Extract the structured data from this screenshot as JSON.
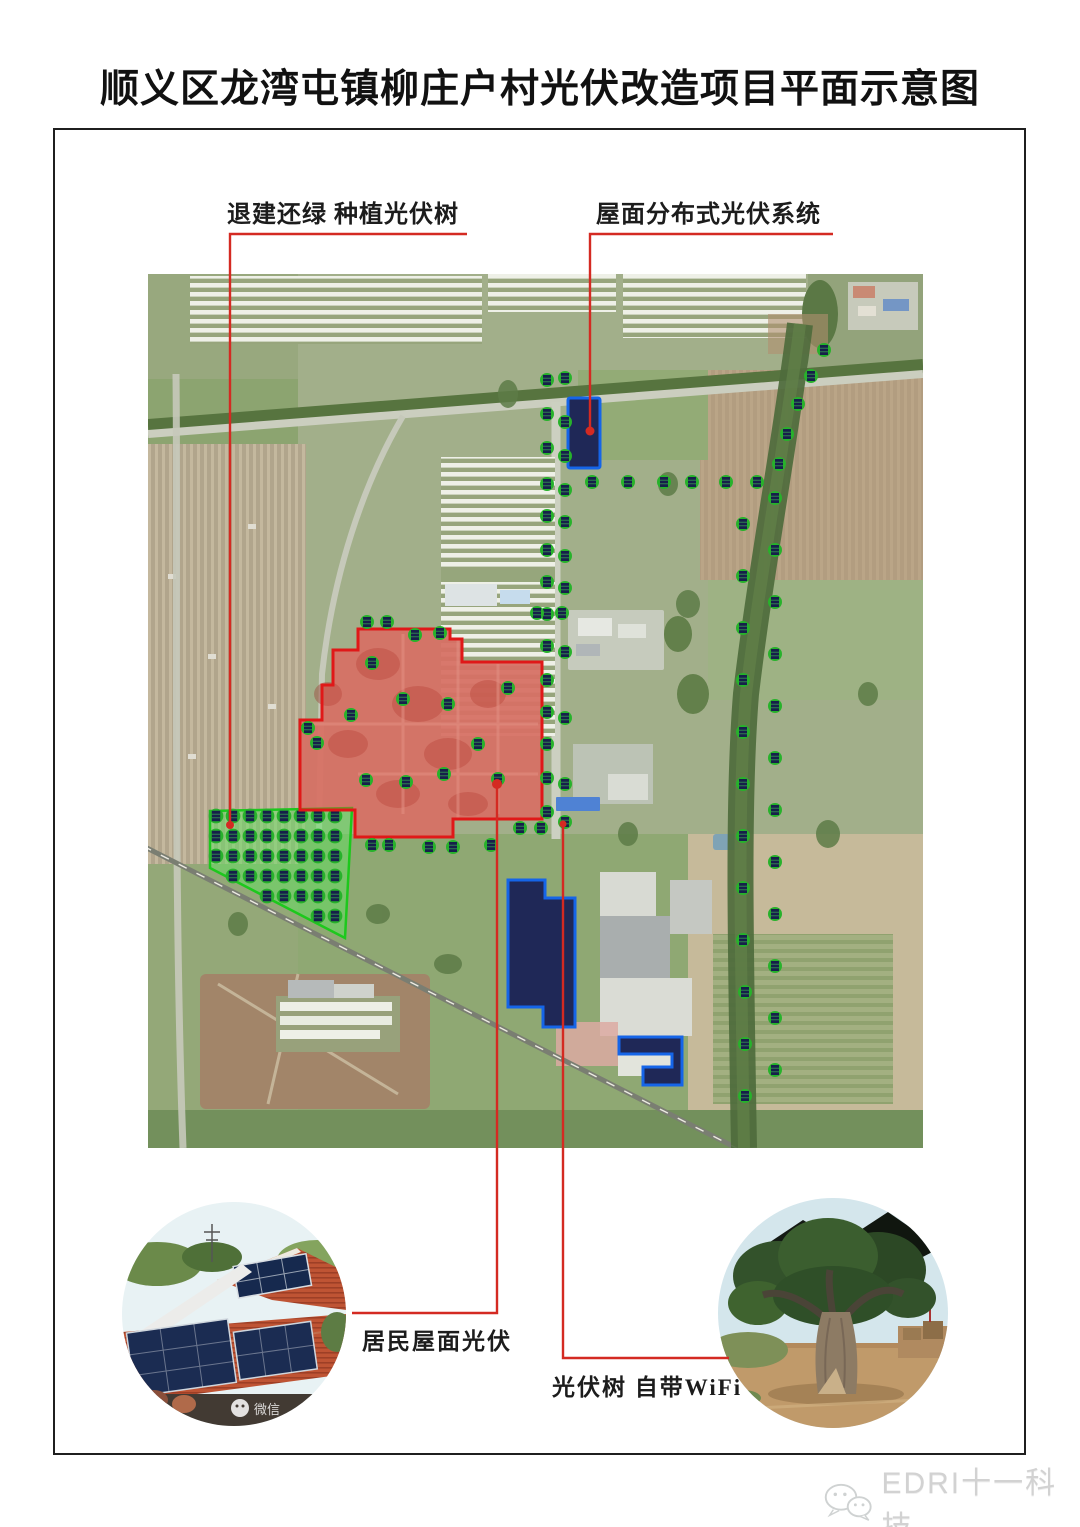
{
  "page": {
    "title": "顺义区龙湾屯镇柳庄户村光伏改造项目平面示意图",
    "watermark_text": "EDRI十一科技"
  },
  "annotations": {
    "top_left_label": "退建还绿 种植光伏树",
    "top_right_label": "屋面分布式光伏系统",
    "bottom_left_label": "居民屋面光伏",
    "bottom_right_label": "光伏树 自带WiFi"
  },
  "legend_photos": {
    "left": {
      "content": "rooftop solar panels on red tile roofs",
      "photo_watermark": "微信"
    },
    "right": {
      "content": "photovoltaic tree"
    }
  },
  "colors": {
    "accent_red": "#d42a22",
    "zone_red": "#e01818",
    "zone_green": "#1dc81d",
    "pv_blue_border": "#1565e8",
    "pv_blue_fill": "#1f2857",
    "dot_green": "#27b22b",
    "watermark_grey": "#d2d2d2"
  },
  "map": {
    "type": "satellite-plan",
    "overlays": {
      "village_zone": {
        "meaning": "rooftop PV village area",
        "stroke": "#e01818"
      },
      "green_return_zone": {
        "meaning": "demolish & re-green, plant PV trees",
        "stroke": "#1dc81d"
      },
      "rooftop_pv_buildings_count": 3,
      "pv_tree_dot_count": 123
    },
    "pv_tree_dots": [
      [
        399,
        106
      ],
      [
        417,
        104
      ],
      [
        399,
        140
      ],
      [
        417,
        148
      ],
      [
        399,
        174
      ],
      [
        417,
        182
      ],
      [
        399,
        210
      ],
      [
        417,
        216
      ],
      [
        399,
        242
      ],
      [
        417,
        248
      ],
      [
        399,
        276
      ],
      [
        417,
        282
      ],
      [
        399,
        308
      ],
      [
        417,
        314
      ],
      [
        399,
        340
      ],
      [
        399,
        372
      ],
      [
        417,
        378
      ],
      [
        399,
        406
      ],
      [
        399,
        438
      ],
      [
        417,
        444
      ],
      [
        399,
        470
      ],
      [
        399,
        504
      ],
      [
        417,
        510
      ],
      [
        399,
        538
      ],
      [
        417,
        548
      ],
      [
        444,
        208
      ],
      [
        480,
        208
      ],
      [
        516,
        208
      ],
      [
        544,
        208
      ],
      [
        578,
        208
      ],
      [
        609,
        208
      ],
      [
        676,
        76
      ],
      [
        663,
        102
      ],
      [
        650,
        130
      ],
      [
        639,
        160
      ],
      [
        631,
        190
      ],
      [
        627,
        224
      ],
      [
        595,
        250
      ],
      [
        627,
        276
      ],
      [
        595,
        302
      ],
      [
        627,
        328
      ],
      [
        595,
        354
      ],
      [
        627,
        380
      ],
      [
        595,
        406
      ],
      [
        627,
        432
      ],
      [
        595,
        458
      ],
      [
        627,
        484
      ],
      [
        595,
        510
      ],
      [
        627,
        536
      ],
      [
        595,
        562
      ],
      [
        627,
        588
      ],
      [
        595,
        614
      ],
      [
        627,
        640
      ],
      [
        595,
        666
      ],
      [
        627,
        692
      ],
      [
        597,
        718
      ],
      [
        627,
        744
      ],
      [
        597,
        770
      ],
      [
        627,
        796
      ],
      [
        597,
        822
      ],
      [
        219,
        348
      ],
      [
        239,
        348
      ],
      [
        267,
        361
      ],
      [
        292,
        359
      ],
      [
        224,
        389
      ],
      [
        203,
        441
      ],
      [
        255,
        425
      ],
      [
        300,
        430
      ],
      [
        360,
        414
      ],
      [
        330,
        470
      ],
      [
        296,
        500
      ],
      [
        258,
        508
      ],
      [
        218,
        506
      ],
      [
        350,
        505
      ],
      [
        160,
        454
      ],
      [
        169,
        469
      ],
      [
        389,
        339
      ],
      [
        414,
        339
      ],
      [
        224,
        571
      ],
      [
        241,
        571
      ],
      [
        281,
        573
      ],
      [
        305,
        573
      ],
      [
        343,
        571
      ],
      [
        372,
        554
      ],
      [
        393,
        554
      ]
    ],
    "green_zone_dots": [
      [
        68,
        542
      ],
      [
        68,
        562
      ],
      [
        68,
        582
      ],
      [
        85,
        542
      ],
      [
        85,
        562
      ],
      [
        85,
        582
      ],
      [
        85,
        602
      ],
      [
        102,
        542
      ],
      [
        102,
        562
      ],
      [
        102,
        582
      ],
      [
        102,
        602
      ],
      [
        119,
        542
      ],
      [
        119,
        562
      ],
      [
        119,
        582
      ],
      [
        119,
        602
      ],
      [
        119,
        622
      ],
      [
        136,
        542
      ],
      [
        136,
        562
      ],
      [
        136,
        582
      ],
      [
        136,
        602
      ],
      [
        136,
        622
      ],
      [
        153,
        542
      ],
      [
        153,
        562
      ],
      [
        153,
        582
      ],
      [
        153,
        602
      ],
      [
        153,
        622
      ],
      [
        170,
        542
      ],
      [
        170,
        562
      ],
      [
        170,
        582
      ],
      [
        170,
        602
      ],
      [
        170,
        622
      ],
      [
        170,
        642
      ],
      [
        187,
        542
      ],
      [
        187,
        562
      ],
      [
        187,
        582
      ],
      [
        187,
        602
      ],
      [
        187,
        622
      ],
      [
        187,
        642
      ]
    ]
  }
}
